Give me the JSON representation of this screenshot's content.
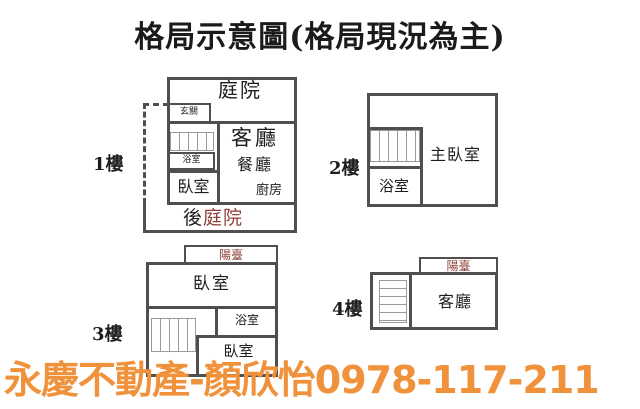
{
  "title": "格局示意圖(格局現況為主)",
  "watermark": "永慶不動產-顏欣怡0978-117-211",
  "colors": {
    "wall": "#4f4f4f",
    "stair": "#9a9a9a",
    "text": "#1d1d1d",
    "accent_red": "#8e4038",
    "watermark_orange": "#f0923b"
  },
  "floors": [
    {
      "label": "1樓",
      "rooms": {
        "courtyard": "庭院",
        "entrance": "玄關",
        "bathroom": "浴室",
        "bedroom": "臥室",
        "living": "客廳",
        "dining": "餐廳",
        "kitchen": "廚房",
        "back_prefix": "後",
        "back_courtyard": "庭院"
      }
    },
    {
      "label": "2樓",
      "rooms": {
        "master_bedroom": "主臥室",
        "bathroom": "浴室"
      }
    },
    {
      "label": "3樓",
      "rooms": {
        "balcony": "陽臺",
        "bedroom_upper": "臥室",
        "bathroom": "浴室",
        "bedroom_lower": "臥室"
      }
    },
    {
      "label": "4樓",
      "rooms": {
        "balcony": "陽臺",
        "living": "客廳"
      }
    }
  ]
}
